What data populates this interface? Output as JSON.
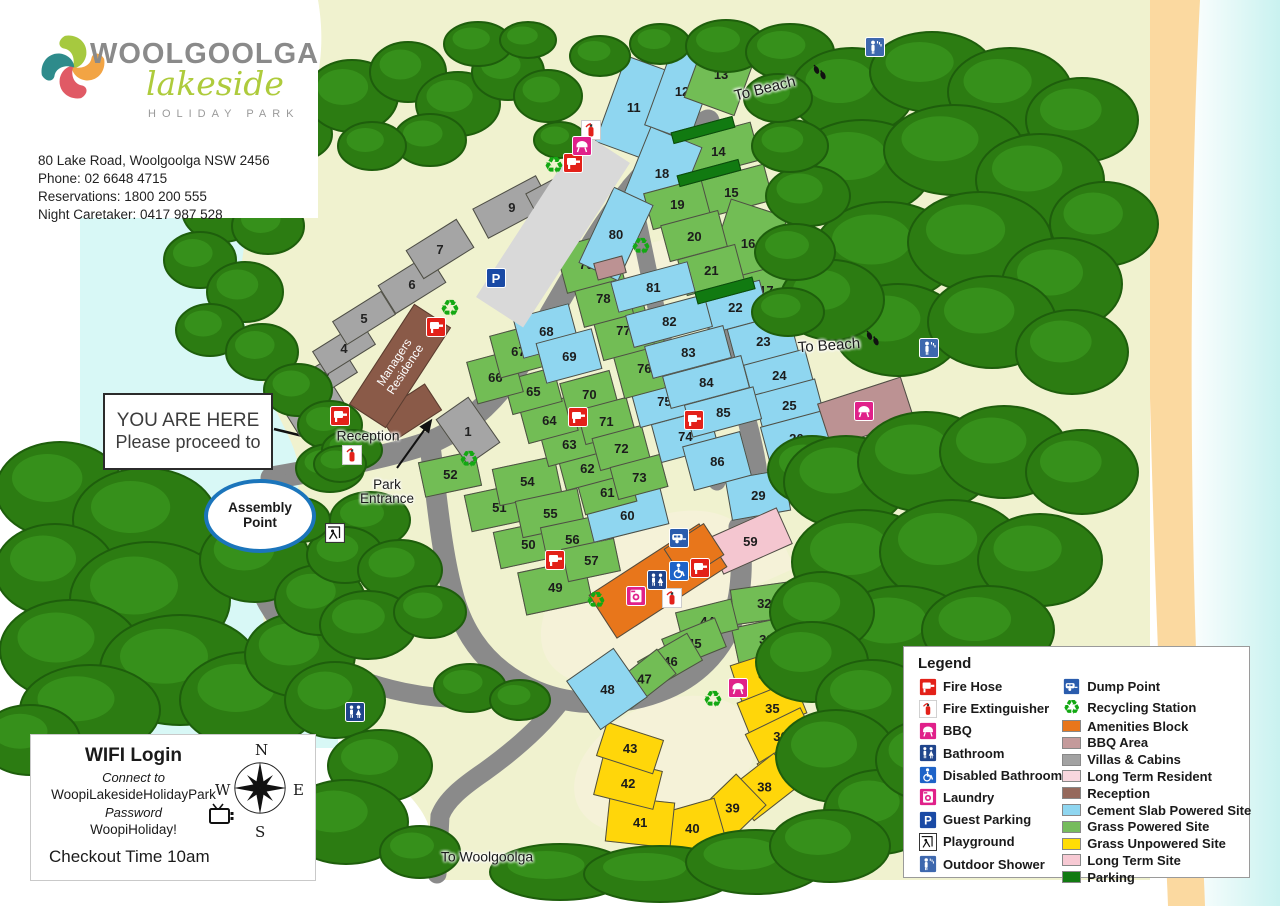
{
  "header": {
    "brand_name": "WOOLGOOLGA",
    "brand_script": "lakeside",
    "brand_sub": "HOLIDAY PARK",
    "address": "80 Lake Road, Woolgoolga NSW 2456",
    "phone": "Phone: 02 6648 4715",
    "reservations": "Reservations: 1800 200 555",
    "caretaker": "Night Caretaker: 0417 987 528"
  },
  "callouts": {
    "you_are_here_line1": "YOU ARE HERE",
    "you_are_here_line2": "Please proceed to",
    "assembly_line1": "Assembly",
    "assembly_line2": "Point"
  },
  "info_box": {
    "wifi_title": "WIFI Login",
    "connect_label": "Connect to",
    "network": "WoopiLakesideHolidayPark",
    "password_label": "Password",
    "password": "WoopiHoliday!",
    "checkout": "Checkout Time 10am",
    "compass": {
      "n": "N",
      "e": "E",
      "s": "S",
      "w": "W"
    }
  },
  "legend": {
    "title": "Legend",
    "icon_items": [
      {
        "icon": "fire-hose",
        "label": "Fire Hose"
      },
      {
        "icon": "fire-ext",
        "label": "Fire Extinguisher"
      },
      {
        "icon": "bbq",
        "label": "BBQ"
      },
      {
        "icon": "bathroom",
        "label": "Bathroom"
      },
      {
        "icon": "disabled",
        "label": "Disabled Bathroom"
      },
      {
        "icon": "laundry",
        "label": "Laundry"
      },
      {
        "icon": "parking",
        "label": "Guest Parking"
      },
      {
        "icon": "playground",
        "label": "Playground"
      },
      {
        "icon": "shower",
        "label": "Outdoor Shower"
      }
    ],
    "swatch_items": [
      {
        "icon": "dump",
        "label": "Dump Point"
      },
      {
        "icon": "recycle",
        "label": "Recycling Station"
      },
      {
        "swatch": "#E8761B",
        "label": "Amenities Block"
      },
      {
        "swatch": "#C49A9B",
        "label": "BBQ Area"
      },
      {
        "swatch": "#A2A2A2",
        "label": "Villas & Cabins"
      },
      {
        "swatch": "#F8D7DE",
        "label": "Long Term Resident"
      },
      {
        "swatch": "#96695C",
        "label": "Reception"
      },
      {
        "swatch": "#8FD6F0",
        "label": "Cement Slab Powered Site"
      },
      {
        "swatch": "#76BC5D",
        "label": "Grass Powered Site"
      },
      {
        "swatch": "#FFDD05",
        "label": "Grass Unpowered Site"
      },
      {
        "swatch": "#F7C9D3",
        "label": "Long Term Site"
      },
      {
        "swatch": "#117A11",
        "label": "Parking"
      }
    ]
  },
  "map": {
    "colors": {
      "cement": "#8FD6F0",
      "grass": "#72BD55",
      "unpowered": "#FFD60A",
      "longterm": "#F4C6D0",
      "villa": "#A5A5A5",
      "brown": "#8A5A48",
      "amenity": "#E8761B",
      "bbq_area": "#BC9293",
      "parkbar": "#117A11",
      "road": "#8A8A8A",
      "guest_strip": "#D9D9D9"
    },
    "labels": [
      {
        "name": "to-beach-top",
        "text": "To Beach",
        "x": 765,
        "y": 89,
        "r": -14,
        "fs": 15
      },
      {
        "name": "to-beach-right",
        "text": "To Beach",
        "x": 829,
        "y": 346,
        "r": -4,
        "fs": 15
      },
      {
        "name": "to-woolgoolga",
        "text": "To Woolgoolga",
        "x": 487,
        "y": 857,
        "r": 0,
        "fs": 14
      },
      {
        "name": "reception-label",
        "text": "Reception",
        "x": 368,
        "y": 436,
        "r": 0,
        "fs": 14
      },
      {
        "name": "park-entrance-label",
        "text": "Park\nEntrance",
        "x": 387,
        "y": 492,
        "r": 0,
        "fs": 13.5
      }
    ],
    "managers_residence": {
      "text_line1": "Managers",
      "text_line2": "Residence",
      "x": 400,
      "y": 366,
      "w": 120,
      "h": 44,
      "r": -57
    },
    "sites": [
      {
        "n": "11",
        "t": "c",
        "x": 634,
        "y": 107,
        "w": 50,
        "h": 92,
        "r": 20
      },
      {
        "n": "12",
        "t": "c",
        "x": 682,
        "y": 91,
        "w": 48,
        "h": 90,
        "r": 20
      },
      {
        "n": "13",
        "t": "g",
        "x": 721,
        "y": 74,
        "w": 54,
        "h": 70,
        "r": 20
      },
      {
        "n": "14",
        "t": "g",
        "x": 718,
        "y": 151,
        "w": 78,
        "h": 40,
        "r": -15
      },
      {
        "n": "15",
        "t": "g",
        "x": 731,
        "y": 192,
        "w": 78,
        "h": 38,
        "r": -15
      },
      {
        "n": "16",
        "t": "g",
        "x": 748,
        "y": 243,
        "w": 60,
        "h": 74,
        "r": 18
      },
      {
        "n": "17",
        "t": "g",
        "x": 766,
        "y": 290,
        "w": 50,
        "h": 42,
        "r": -15
      },
      {
        "n": "18",
        "t": "c",
        "x": 662,
        "y": 173,
        "w": 56,
        "h": 78,
        "r": 22
      },
      {
        "n": "19",
        "t": "g",
        "x": 677,
        "y": 204,
        "w": 60,
        "h": 38,
        "r": -15
      },
      {
        "n": "20",
        "t": "g",
        "x": 694,
        "y": 236,
        "w": 60,
        "h": 38,
        "r": -15
      },
      {
        "n": "21",
        "t": "g",
        "x": 711,
        "y": 270,
        "w": 60,
        "h": 38,
        "r": -15
      },
      {
        "n": "22",
        "t": "c",
        "x": 735,
        "y": 307,
        "w": 62,
        "h": 40,
        "r": -15
      },
      {
        "n": "23",
        "t": "c",
        "x": 763,
        "y": 341,
        "w": 64,
        "h": 42,
        "r": -15
      },
      {
        "n": "24",
        "t": "c",
        "x": 779,
        "y": 375,
        "w": 64,
        "h": 38,
        "r": -15
      },
      {
        "n": "25",
        "t": "c",
        "x": 789,
        "y": 405,
        "w": 64,
        "h": 38,
        "r": -15
      },
      {
        "n": "26",
        "t": "c",
        "x": 796,
        "y": 438,
        "w": 64,
        "h": 40,
        "r": -15
      },
      {
        "n": "29",
        "t": "c",
        "x": 758,
        "y": 495,
        "w": 60,
        "h": 42,
        "r": -10
      },
      {
        "n": "32",
        "t": "g",
        "x": 764,
        "y": 603,
        "w": 64,
        "h": 36,
        "r": -8
      },
      {
        "n": "33",
        "t": "g",
        "x": 766,
        "y": 639,
        "w": 64,
        "h": 36,
        "r": -12
      },
      {
        "n": "34",
        "t": "y",
        "x": 765,
        "y": 674,
        "w": 62,
        "h": 38,
        "r": -18
      },
      {
        "n": "35",
        "t": "y",
        "x": 772,
        "y": 708,
        "w": 62,
        "h": 36,
        "r": -22
      },
      {
        "n": "36",
        "t": "y",
        "x": 780,
        "y": 736,
        "w": 62,
        "h": 34,
        "r": -26
      },
      {
        "n": "37",
        "t": "y",
        "x": 792,
        "y": 764,
        "w": 60,
        "h": 38,
        "r": -32
      },
      {
        "n": "38",
        "t": "y",
        "x": 764,
        "y": 787,
        "w": 58,
        "h": 42,
        "r": -38
      },
      {
        "n": "39",
        "t": "y",
        "x": 732,
        "y": 808,
        "w": 54,
        "h": 44,
        "r": -44
      },
      {
        "n": "40",
        "t": "y",
        "x": 692,
        "y": 828,
        "w": 60,
        "h": 46,
        "r": -16
      },
      {
        "n": "41",
        "t": "y",
        "x": 640,
        "y": 822,
        "w": 66,
        "h": 46,
        "r": 6
      },
      {
        "n": "42",
        "t": "y",
        "x": 628,
        "y": 783,
        "w": 62,
        "h": 40,
        "r": 14
      },
      {
        "n": "43",
        "t": "y",
        "x": 630,
        "y": 748,
        "w": 60,
        "h": 36,
        "r": 18
      },
      {
        "n": "44",
        "t": "g",
        "x": 707,
        "y": 621,
        "w": 58,
        "h": 32,
        "r": -14
      },
      {
        "n": "45",
        "t": "g",
        "x": 694,
        "y": 643,
        "w": 58,
        "h": 32,
        "r": -22
      },
      {
        "n": "46",
        "t": "g",
        "x": 670,
        "y": 661,
        "w": 58,
        "h": 32,
        "r": -30
      },
      {
        "n": "47",
        "t": "g",
        "x": 644,
        "y": 679,
        "w": 58,
        "h": 32,
        "r": -38
      },
      {
        "n": "48",
        "t": "c",
        "x": 607,
        "y": 689,
        "w": 58,
        "h": 60,
        "r": -35
      },
      {
        "n": "49",
        "t": "g",
        "x": 555,
        "y": 587,
        "w": 68,
        "h": 44,
        "r": -12
      },
      {
        "n": "50",
        "t": "g",
        "x": 528,
        "y": 544,
        "w": 64,
        "h": 38,
        "r": -12
      },
      {
        "n": "51",
        "t": "g",
        "x": 499,
        "y": 507,
        "w": 64,
        "h": 38,
        "r": -12
      },
      {
        "n": "52",
        "t": "g",
        "x": 450,
        "y": 474,
        "w": 58,
        "h": 36,
        "r": -12
      },
      {
        "n": "54",
        "t": "g",
        "x": 527,
        "y": 481,
        "w": 64,
        "h": 38,
        "r": -12
      },
      {
        "n": "55",
        "t": "g",
        "x": 550,
        "y": 513,
        "w": 64,
        "h": 38,
        "r": -12
      },
      {
        "n": "56",
        "t": "g",
        "x": 572,
        "y": 539,
        "w": 58,
        "h": 36,
        "r": -12
      },
      {
        "n": "57",
        "t": "g",
        "x": 591,
        "y": 560,
        "w": 54,
        "h": 34,
        "r": -12
      },
      {
        "n": "59",
        "t": "p",
        "x": 750,
        "y": 541,
        "w": 76,
        "h": 40,
        "r": -24
      },
      {
        "n": "60",
        "t": "c",
        "x": 627,
        "y": 515,
        "w": 78,
        "h": 38,
        "r": -14
      },
      {
        "n": "61",
        "t": "g",
        "x": 607,
        "y": 492,
        "w": 54,
        "h": 34,
        "r": -15
      },
      {
        "n": "62",
        "t": "g",
        "x": 587,
        "y": 468,
        "w": 52,
        "h": 34,
        "r": -15
      },
      {
        "n": "63",
        "t": "g",
        "x": 569,
        "y": 444,
        "w": 52,
        "h": 34,
        "r": -15
      },
      {
        "n": "64",
        "t": "g",
        "x": 549,
        "y": 420,
        "w": 52,
        "h": 36,
        "r": -15
      },
      {
        "n": "65",
        "t": "g",
        "x": 533,
        "y": 391,
        "w": 52,
        "h": 36,
        "r": -15
      },
      {
        "n": "66",
        "t": "g",
        "x": 495,
        "y": 377,
        "w": 48,
        "h": 44,
        "r": -15
      },
      {
        "n": "67",
        "t": "g",
        "x": 518,
        "y": 351,
        "w": 48,
        "h": 44,
        "r": -15
      },
      {
        "n": "68",
        "t": "c",
        "x": 546,
        "y": 331,
        "w": 58,
        "h": 42,
        "r": -15
      },
      {
        "n": "69",
        "t": "c",
        "x": 569,
        "y": 356,
        "w": 58,
        "h": 42,
        "r": -15
      },
      {
        "n": "70",
        "t": "g",
        "x": 589,
        "y": 394,
        "w": 52,
        "h": 36,
        "r": -15
      },
      {
        "n": "71",
        "t": "g",
        "x": 606,
        "y": 421,
        "w": 52,
        "h": 36,
        "r": -15
      },
      {
        "n": "72",
        "t": "g",
        "x": 621,
        "y": 448,
        "w": 52,
        "h": 34,
        "r": -15
      },
      {
        "n": "73",
        "t": "g",
        "x": 639,
        "y": 477,
        "w": 52,
        "h": 34,
        "r": -15
      },
      {
        "n": "74",
        "t": "c",
        "x": 685,
        "y": 436,
        "w": 60,
        "h": 40,
        "r": -15
      },
      {
        "n": "75",
        "t": "c",
        "x": 664,
        "y": 401,
        "w": 60,
        "h": 40,
        "r": -15
      },
      {
        "n": "76",
        "t": "g",
        "x": 644,
        "y": 368,
        "w": 54,
        "h": 50,
        "r": -15
      },
      {
        "n": "77",
        "t": "g",
        "x": 623,
        "y": 330,
        "w": 54,
        "h": 50,
        "r": -15
      },
      {
        "n": "78",
        "t": "g",
        "x": 603,
        "y": 298,
        "w": 52,
        "h": 48,
        "r": -15
      },
      {
        "n": "79",
        "t": "g",
        "x": 586,
        "y": 264,
        "w": 52,
        "h": 48,
        "r": -15
      },
      {
        "n": "80",
        "t": "c",
        "x": 616,
        "y": 234,
        "w": 44,
        "h": 84,
        "r": 25
      },
      {
        "n": "81",
        "t": "c",
        "x": 653,
        "y": 287,
        "w": 80,
        "h": 32,
        "r": -15
      },
      {
        "n": "82",
        "t": "c",
        "x": 669,
        "y": 321,
        "w": 82,
        "h": 34,
        "r": -15
      },
      {
        "n": "83",
        "t": "c",
        "x": 688,
        "y": 352,
        "w": 82,
        "h": 34,
        "r": -15
      },
      {
        "n": "84",
        "t": "c",
        "x": 706,
        "y": 382,
        "w": 82,
        "h": 34,
        "r": -15
      },
      {
        "n": "85",
        "t": "c",
        "x": 723,
        "y": 412,
        "w": 72,
        "h": 34,
        "r": -15
      },
      {
        "n": "86",
        "t": "c",
        "x": 717,
        "y": 461,
        "w": 60,
        "h": 46,
        "r": -15
      },
      {
        "n": "",
        "t": "d",
        "x": 703,
        "y": 130,
        "w": 64,
        "h": 12,
        "r": -15
      },
      {
        "n": "",
        "t": "d",
        "x": 709,
        "y": 173,
        "w": 64,
        "h": 12,
        "r": -15
      },
      {
        "n": "",
        "t": "d",
        "x": 725,
        "y": 290,
        "w": 60,
        "h": 13,
        "r": -15
      }
    ],
    "buildings": [
      {
        "n": "1",
        "t": "v",
        "x": 468,
        "y": 431,
        "w": 40,
        "h": 56,
        "r": -35
      },
      {
        "n": "2",
        "t": "v",
        "x": 316,
        "y": 410,
        "w": 56,
        "h": 28,
        "r": -32
      },
      {
        "n": "3",
        "t": "v",
        "x": 326,
        "y": 376,
        "w": 58,
        "h": 28,
        "r": -32
      },
      {
        "n": "4",
        "t": "v",
        "x": 344,
        "y": 348,
        "w": 58,
        "h": 28,
        "r": -32
      },
      {
        "n": "5",
        "t": "v",
        "x": 364,
        "y": 318,
        "w": 58,
        "h": 28,
        "r": -32
      },
      {
        "n": "6",
        "t": "v",
        "x": 412,
        "y": 284,
        "w": 60,
        "h": 34,
        "r": -32
      },
      {
        "n": "7",
        "t": "v",
        "x": 440,
        "y": 249,
        "w": 60,
        "h": 34,
        "r": -32
      },
      {
        "n": "9",
        "t": "v",
        "x": 512,
        "y": 207,
        "w": 72,
        "h": 34,
        "r": -28
      },
      {
        "n": "10",
        "t": "v",
        "x": 557,
        "y": 196,
        "w": 54,
        "h": 34,
        "r": -28
      },
      {
        "n": "",
        "t": "b",
        "x": 410,
        "y": 412,
        "w": 56,
        "h": 32,
        "r": -33
      },
      {
        "n": "",
        "t": "a",
        "x": 658,
        "y": 581,
        "w": 132,
        "h": 52,
        "r": -33
      },
      {
        "n": "",
        "t": "a",
        "x": 694,
        "y": 552,
        "w": 48,
        "h": 38,
        "r": -33
      },
      {
        "n": "",
        "t": "m",
        "x": 610,
        "y": 268,
        "w": 30,
        "h": 18,
        "r": -15
      },
      {
        "n": "",
        "t": "m",
        "x": 866,
        "y": 412,
        "w": 88,
        "h": 46,
        "r": -18
      },
      {
        "n": "",
        "t": "s",
        "x": 553,
        "y": 230,
        "w": 196,
        "h": 56,
        "r": -57
      }
    ],
    "icons": [
      {
        "type": "fire-hose",
        "x": 340,
        "y": 416
      },
      {
        "type": "fire-hose",
        "x": 436,
        "y": 327
      },
      {
        "type": "fire-hose",
        "x": 573,
        "y": 163
      },
      {
        "type": "fire-hose",
        "x": 578,
        "y": 417
      },
      {
        "type": "fire-hose",
        "x": 694,
        "y": 420
      },
      {
        "type": "fire-hose",
        "x": 555,
        "y": 560
      },
      {
        "type": "fire-hose",
        "x": 700,
        "y": 568
      },
      {
        "type": "fire-ext",
        "x": 352,
        "y": 455
      },
      {
        "type": "fire-ext",
        "x": 591,
        "y": 130
      },
      {
        "type": "fire-ext",
        "x": 672,
        "y": 598
      },
      {
        "type": "bbq",
        "x": 582,
        "y": 146
      },
      {
        "type": "bbq",
        "x": 864,
        "y": 411
      },
      {
        "type": "bbq",
        "x": 738,
        "y": 688
      },
      {
        "type": "bathroom",
        "x": 657,
        "y": 580
      },
      {
        "type": "bathroom",
        "x": 355,
        "y": 712
      },
      {
        "type": "disabled",
        "x": 679,
        "y": 571
      },
      {
        "type": "laundry",
        "x": 636,
        "y": 596
      },
      {
        "type": "dump",
        "x": 679,
        "y": 538
      },
      {
        "type": "recycle",
        "x": 554,
        "y": 166
      },
      {
        "type": "recycle",
        "x": 450,
        "y": 309
      },
      {
        "type": "recycle",
        "x": 641,
        "y": 247
      },
      {
        "type": "recycle",
        "x": 469,
        "y": 460
      },
      {
        "type": "recycle",
        "x": 596,
        "y": 601
      },
      {
        "type": "recycle",
        "x": 713,
        "y": 700
      },
      {
        "type": "parking",
        "x": 496,
        "y": 278
      },
      {
        "type": "playground",
        "x": 335,
        "y": 533
      },
      {
        "type": "shower",
        "x": 875,
        "y": 47
      },
      {
        "type": "shower",
        "x": 929,
        "y": 348
      },
      {
        "type": "footprints",
        "x": 820,
        "y": 73
      },
      {
        "type": "footprints",
        "x": 873,
        "y": 339
      }
    ]
  }
}
